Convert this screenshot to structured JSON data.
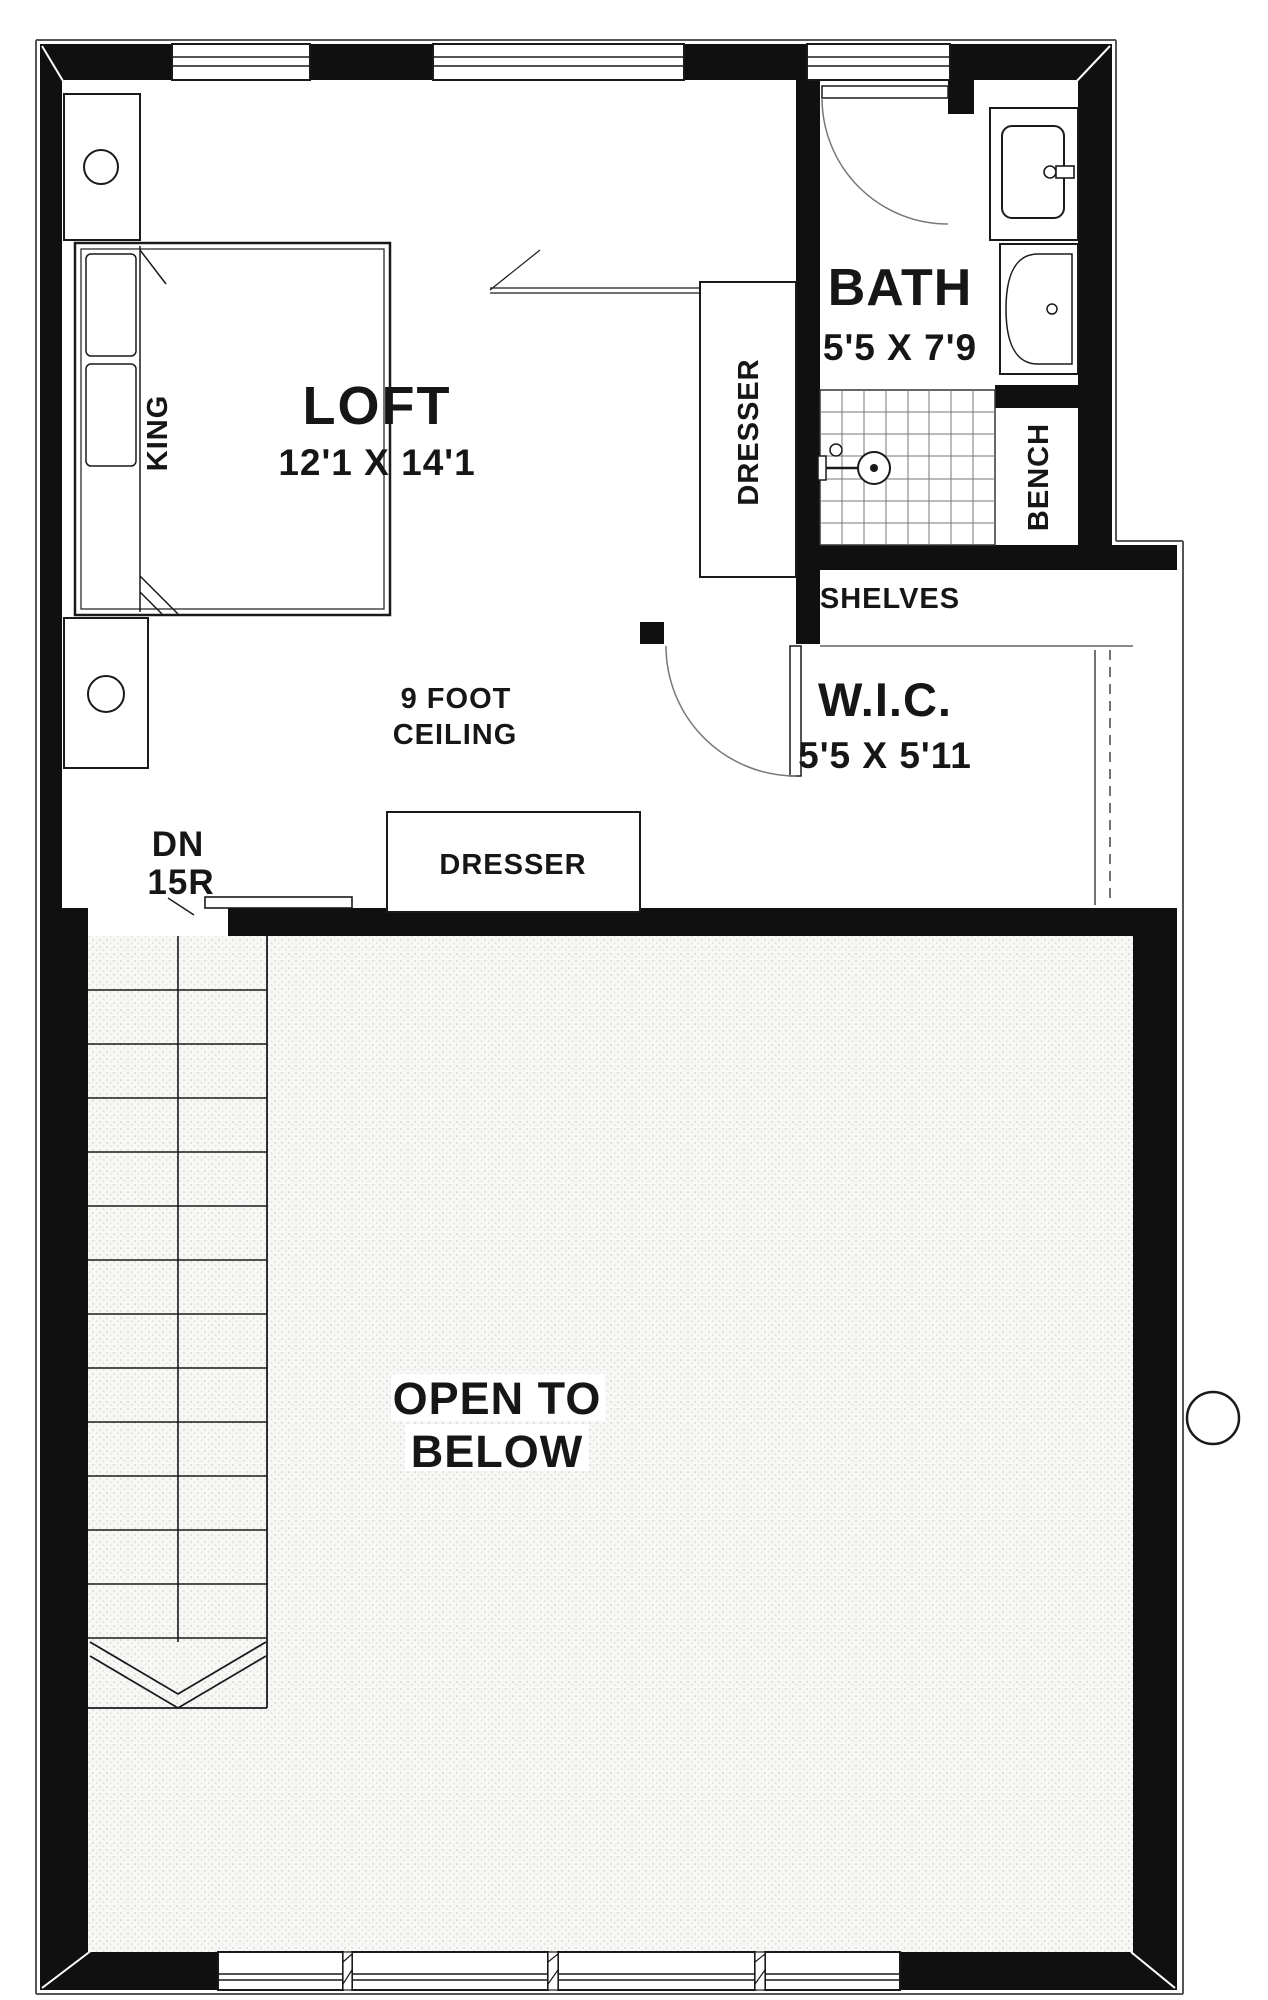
{
  "plan": {
    "rooms": {
      "loft": {
        "name": "LOFT",
        "dims": "12'1 X 14'1",
        "ceiling_note_line1": "9 FOOT",
        "ceiling_note_line2": "CEILING",
        "bed_label": "KING"
      },
      "bath": {
        "name": "BATH",
        "dims": "5'5 X 7'9",
        "bench_label": "BENCH"
      },
      "wic": {
        "name": "W.I.C.",
        "dims": "5'5 X 5'11",
        "shelves_label": "SHELVES"
      },
      "open_below": {
        "line1": "OPEN TO",
        "line2": "BELOW"
      }
    },
    "stairs": {
      "direction_label": "DN",
      "riser_label": "15R"
    },
    "furniture": {
      "tall_dresser_label": "DRESSER",
      "low_dresser_label": "DRESSER"
    },
    "colors": {
      "wall": "#101010",
      "line": "#1a1a1a",
      "floor": "#ffffff",
      "stipple_dot": "#c9c9c6",
      "keyline": "#555555"
    }
  }
}
